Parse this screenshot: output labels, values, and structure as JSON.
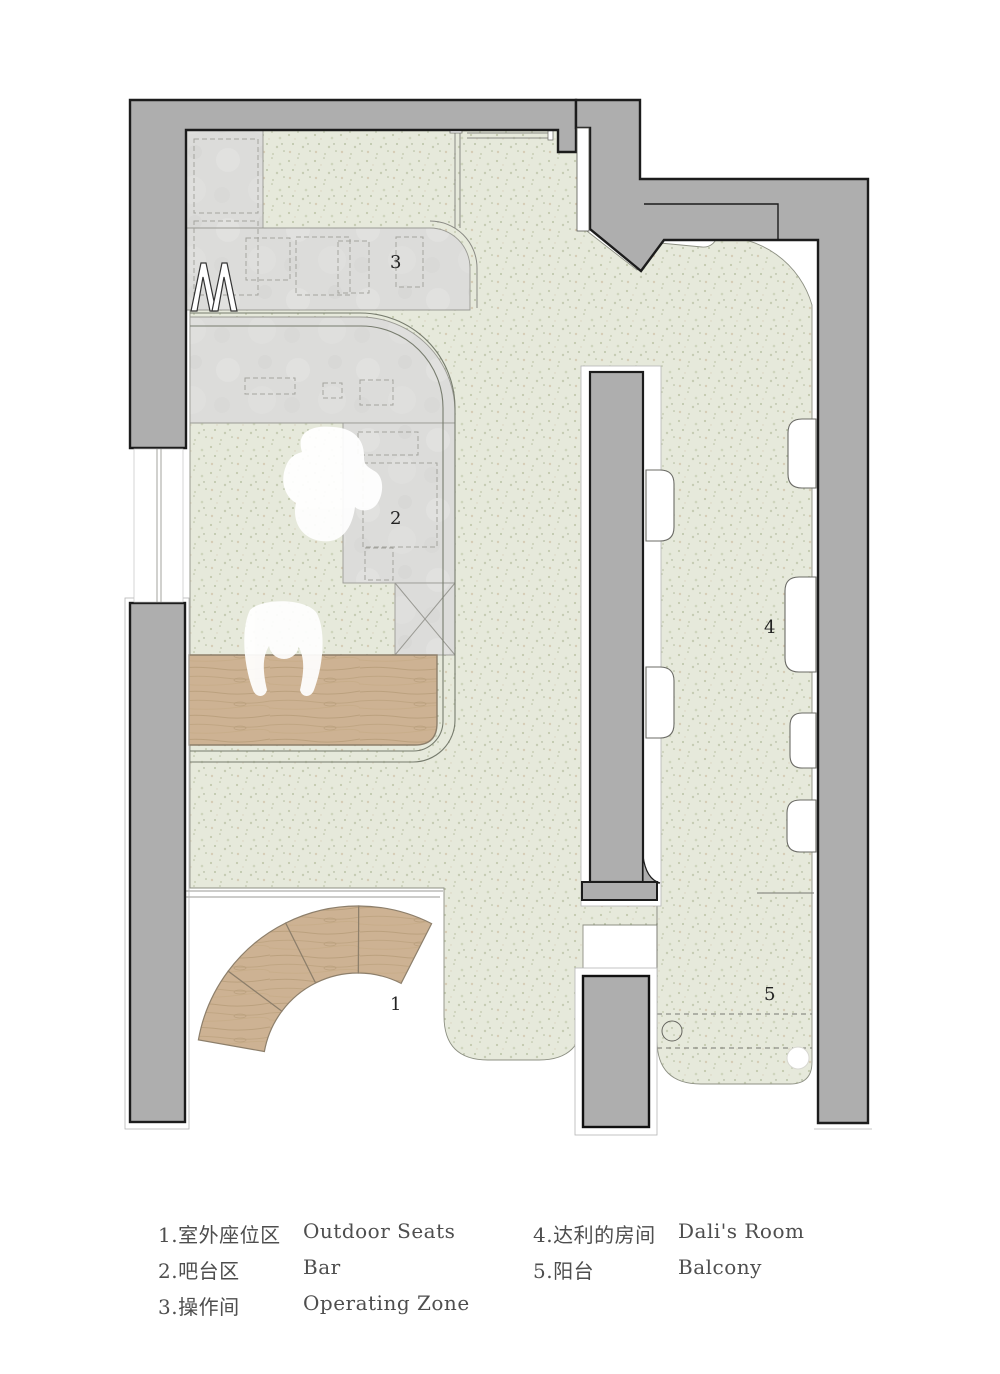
{
  "plan": {
    "rooms": [
      {
        "number": "1",
        "zh": "室外座位区",
        "en": "Outdoor Seats"
      },
      {
        "number": "2",
        "zh": "吧台区",
        "en": "Bar"
      },
      {
        "number": "3",
        "zh": "操作间",
        "en": "Operating Zone"
      },
      {
        "number": "4",
        "zh": "达利的房间",
        "en": "Dali's Room"
      },
      {
        "number": "5",
        "zh": "阳台",
        "en": "Balcony"
      }
    ]
  },
  "legend": {
    "items": [
      {
        "zh": "1.室外座位区",
        "en": "Outdoor Seats"
      },
      {
        "zh": "2.吧台区",
        "en": "Bar"
      },
      {
        "zh": "3.操作间",
        "en": "Operating Zone"
      },
      {
        "zh": "4.达利的房间",
        "en": "Dali's Room"
      },
      {
        "zh": "5.阳台",
        "en": "Balcony"
      }
    ]
  },
  "colors": {
    "wall": "#aeaeae",
    "wall_outline": "#1c1c1c",
    "floor": "#e6e9db",
    "marble": "#dcdcda",
    "wood": "#cdb293",
    "boundary_line": "#777c6e",
    "legend_text": "#4e4e4e"
  }
}
